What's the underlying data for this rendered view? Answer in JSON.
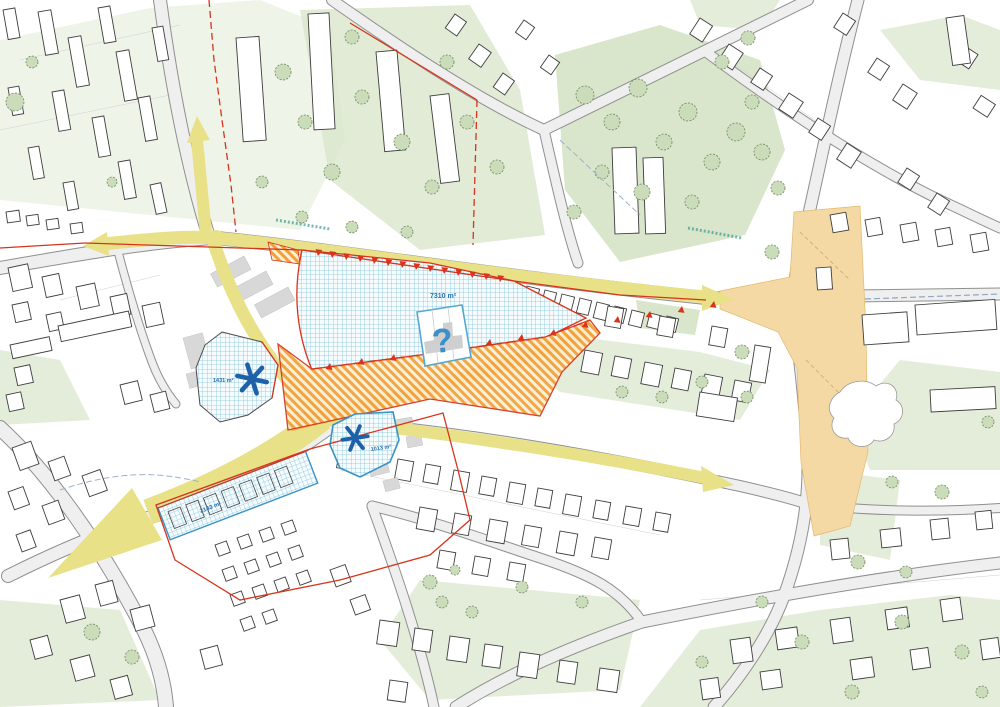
{
  "map": {
    "title": "Urban development plan map",
    "labels": {
      "main_site_area": "7310 m²",
      "west_site_area": "1431 m²",
      "south_site_area": "1013 m²",
      "strip_site_area": "2143 m²",
      "undetermined_marker": "?"
    },
    "colors": {
      "route_yellow": "#e8e187",
      "site_grid_blue": "#86c5dc",
      "buffer_hatch_orange": "#efa03a",
      "plaza_tan": "#f5d9a4",
      "boundary_red": "#d6341c",
      "marker_blue": "#1d61a8",
      "vegetation_green": "#e4edda"
    }
  }
}
